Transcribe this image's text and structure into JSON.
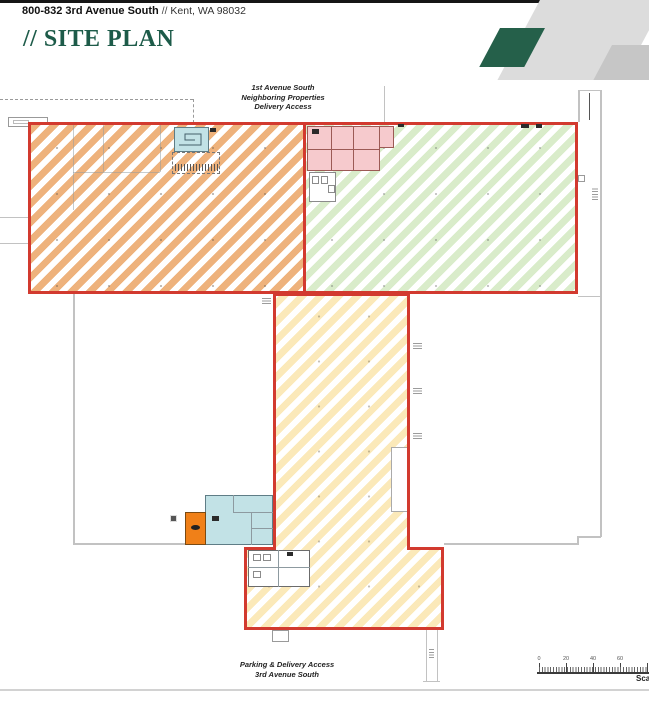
{
  "header": {
    "address": "800-832 3rd Avenue South",
    "address_separator": "//",
    "city": "Kent, WA 98032",
    "title": "// SITE PLAN"
  },
  "plan": {
    "top_label": [
      "1st Avenue South",
      "Neighboring Properties",
      "Delivery Access"
    ],
    "bottom_label": [
      "Parking & Delivery Access",
      "3rd Avenue South"
    ],
    "scale": {
      "labels": [
        "0",
        "20",
        "40",
        "60"
      ],
      "caption": "Scale"
    }
  },
  "colors": {
    "brand_green": "#1d5b49",
    "banner_gray_light": "#dcdcdc",
    "banner_gray_mid": "#c6c6c6",
    "parcel_outline_red": "#d23a2f",
    "hatch_orange": "#eeb27c",
    "hatch_green": "#d9ecca",
    "hatch_yellow": "#fbe9b9",
    "room_cyan": "#c2e2e6",
    "room_pink": "#f6cacd",
    "block_orange": "#f08018",
    "building_outline_gray": "#c2c2c2"
  }
}
